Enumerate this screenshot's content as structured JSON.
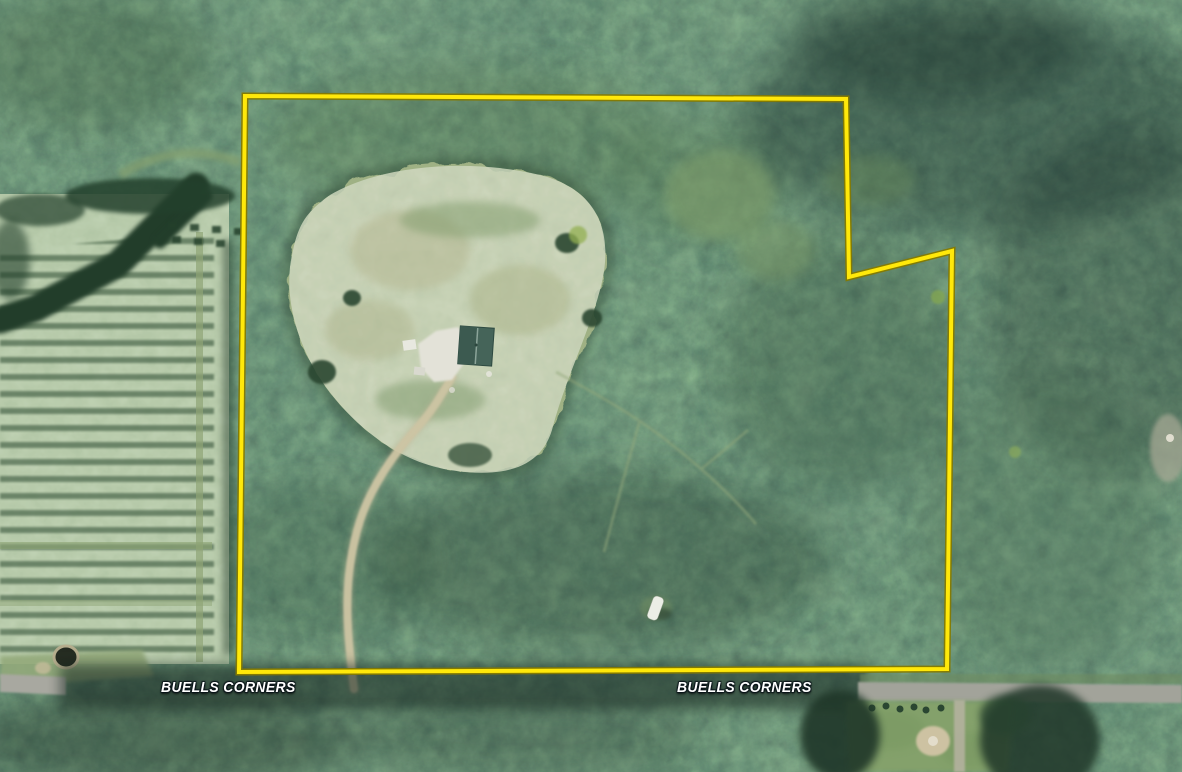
{
  "map": {
    "labels": {
      "left": "BUELLS CORNERS",
      "right": "BUELLS CORNERS"
    }
  },
  "colors": {
    "boundary_line": "#ffe80a",
    "boundary_line_edge": "#857a00",
    "label_text": "#ffffff"
  }
}
